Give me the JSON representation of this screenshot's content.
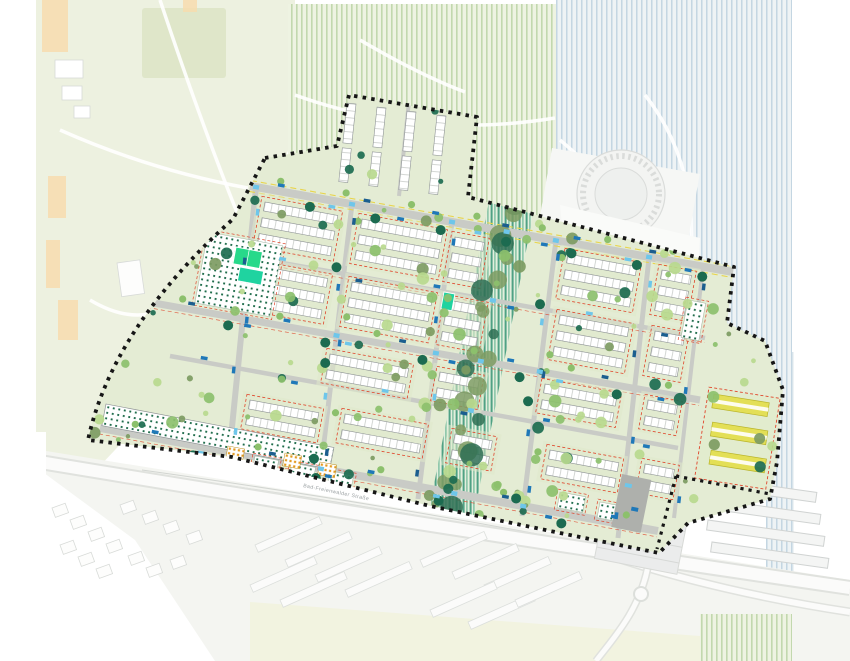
{
  "map": {
    "kind": "urban-masterplan-site-plan",
    "street_label": "Bad-Freienwalder Straße",
    "features": {
      "site_boundary": "development site boundary (black dashed)",
      "housing_rows": "terraced housing slabs",
      "green_corridor": "central striped green corridor",
      "garden_plots": "dot-hatched garden / allotment plots",
      "sports_pitch": "bright green sports pitches",
      "east_parcel": "yellow roofed slabs parcel",
      "north_parcel": "northern housing parcel",
      "context": "surrounding city context (fields, gasometer, main road, parking, greenhouses)",
      "parked_cars": "blue car markers along streets"
    },
    "palette": {
      "pageBg": "#ffffff",
      "contextPark": "#edf1e0",
      "contextParkDark": "#dfe6c9",
      "contextBuilding": "#f9faf8",
      "contextStroke": "#d7dad8",
      "orangeBuilding": "#f7dcae",
      "fieldBgGreen": "#eef3e2",
      "fieldStripeGreen": "#b8d2a2",
      "fieldBgBlue": "#eef3f5",
      "fieldStripeBlue": "#b9cfdd",
      "siteBg": "#e4ecd4",
      "road": "#c9cbc6",
      "roadDark": "#aeb0ac",
      "boundary": "#161616",
      "building": "#ffffff",
      "buildingStroke": "#8f9496",
      "parcelRed": "#df442a",
      "treeLight": "#b9d98e",
      "treeMid": "#8cc06c",
      "treeOlive": "#7d9b62",
      "treeDark": "#1c6b50",
      "corridorBg": "#e3efdd",
      "corridorTeal": "#4fa184",
      "corridorSoft": "#7dbfa0",
      "pitchGreen": "#27d98a",
      "carBlue": "#1f78b8",
      "carCyan": "#6ec6ea",
      "carNavy": "#1b5e8f",
      "dotGarden": "#1d6b4a",
      "dotOrange": "#e3991f",
      "yellowRoof": "#e3df56",
      "laneYellow": "#e8d44d"
    }
  }
}
